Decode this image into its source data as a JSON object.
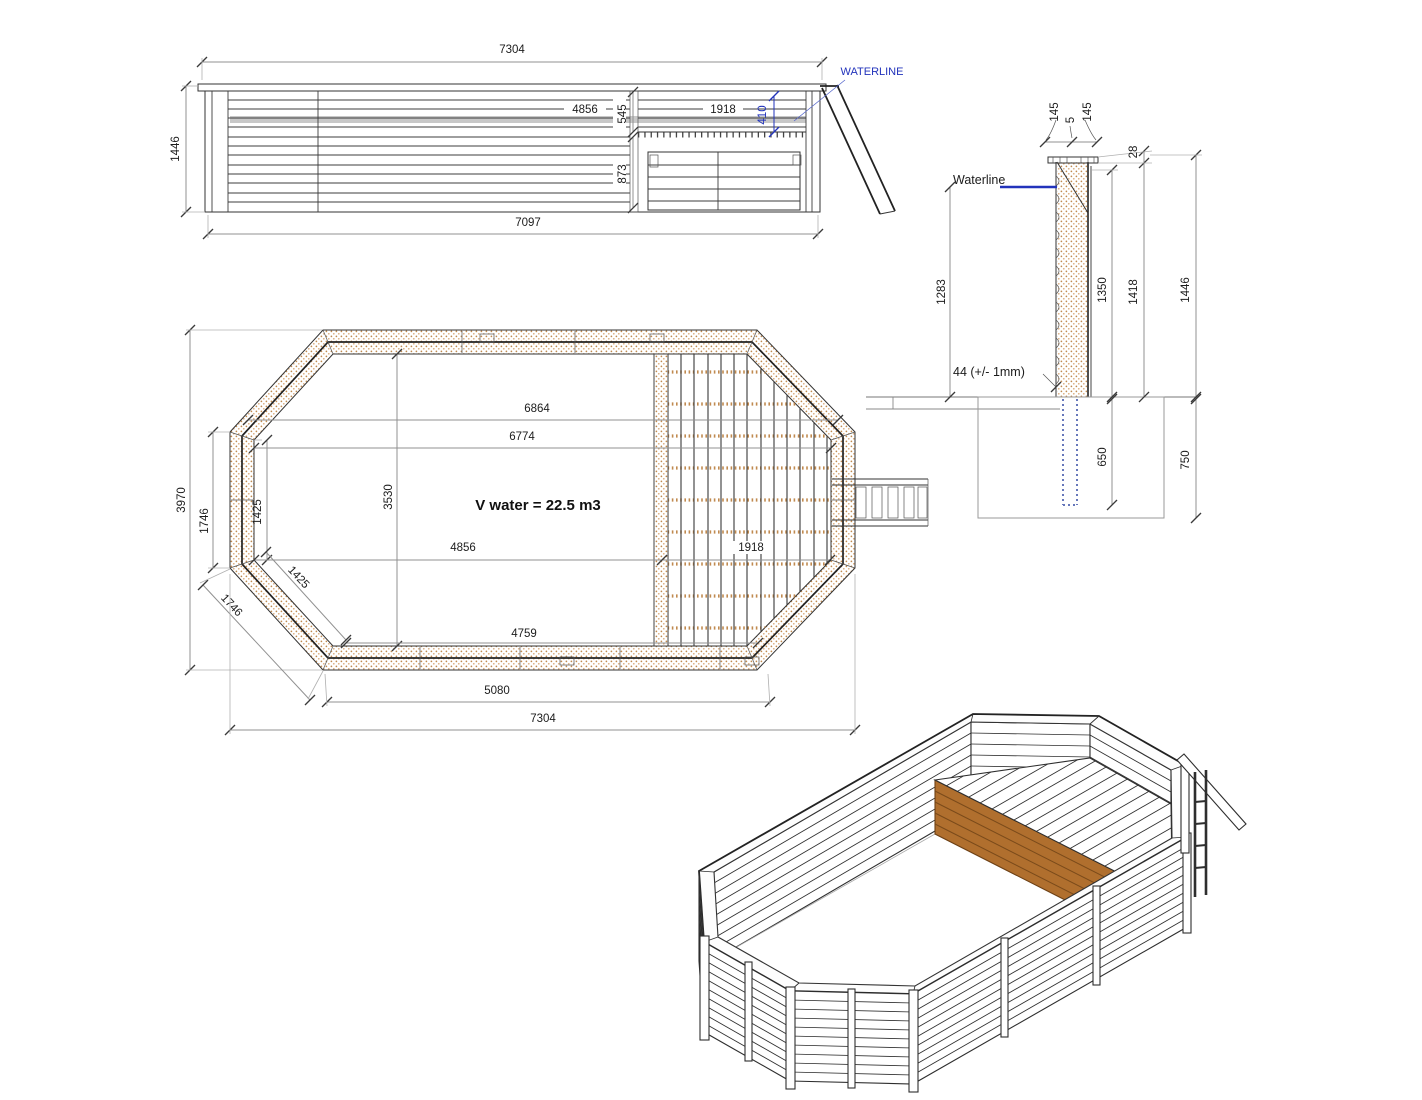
{
  "colors": {
    "blue": "#2233bb",
    "wood": "#c08a50",
    "wood_dark": "#6d4014",
    "deck_face": "#b06f2e",
    "waterband": "#c8c8c8",
    "line": "#333333",
    "dim": "#909090"
  },
  "elevation": {
    "overall_width": "7304",
    "overall_height": "1446",
    "plank_length": "4856",
    "top_to_deck": "545",
    "deck_width": "1918",
    "waterline_offset": "410",
    "deck_height": "873",
    "base_width": "7097",
    "waterline_label": "WATERLINE"
  },
  "section": {
    "cap_front": "145",
    "cap_gap": "5",
    "cap_back": "145",
    "cap_thickness": "28",
    "waterline_label": "Waterline",
    "waterline_to_ground": "1283",
    "wall_height": "1350",
    "height_1418": "1418",
    "overall_height": "1446",
    "plank_note": "44 (+/- 1mm)",
    "post_depth": "650",
    "foundation_depth": "750"
  },
  "plan": {
    "overall_height": "3970",
    "overall_length": "7304",
    "inner_6864": "6864",
    "inner_6774": "6774",
    "inner_width": "3530",
    "volume": "V water = 22.5 m3",
    "floor_length": "4856",
    "deck_length": "1918",
    "panel_left": "1746",
    "inner_left": "1425",
    "diag_inner": "1425",
    "diag_panel": "1746",
    "bottom_inner": "4759",
    "bottom_panel": "5080"
  }
}
